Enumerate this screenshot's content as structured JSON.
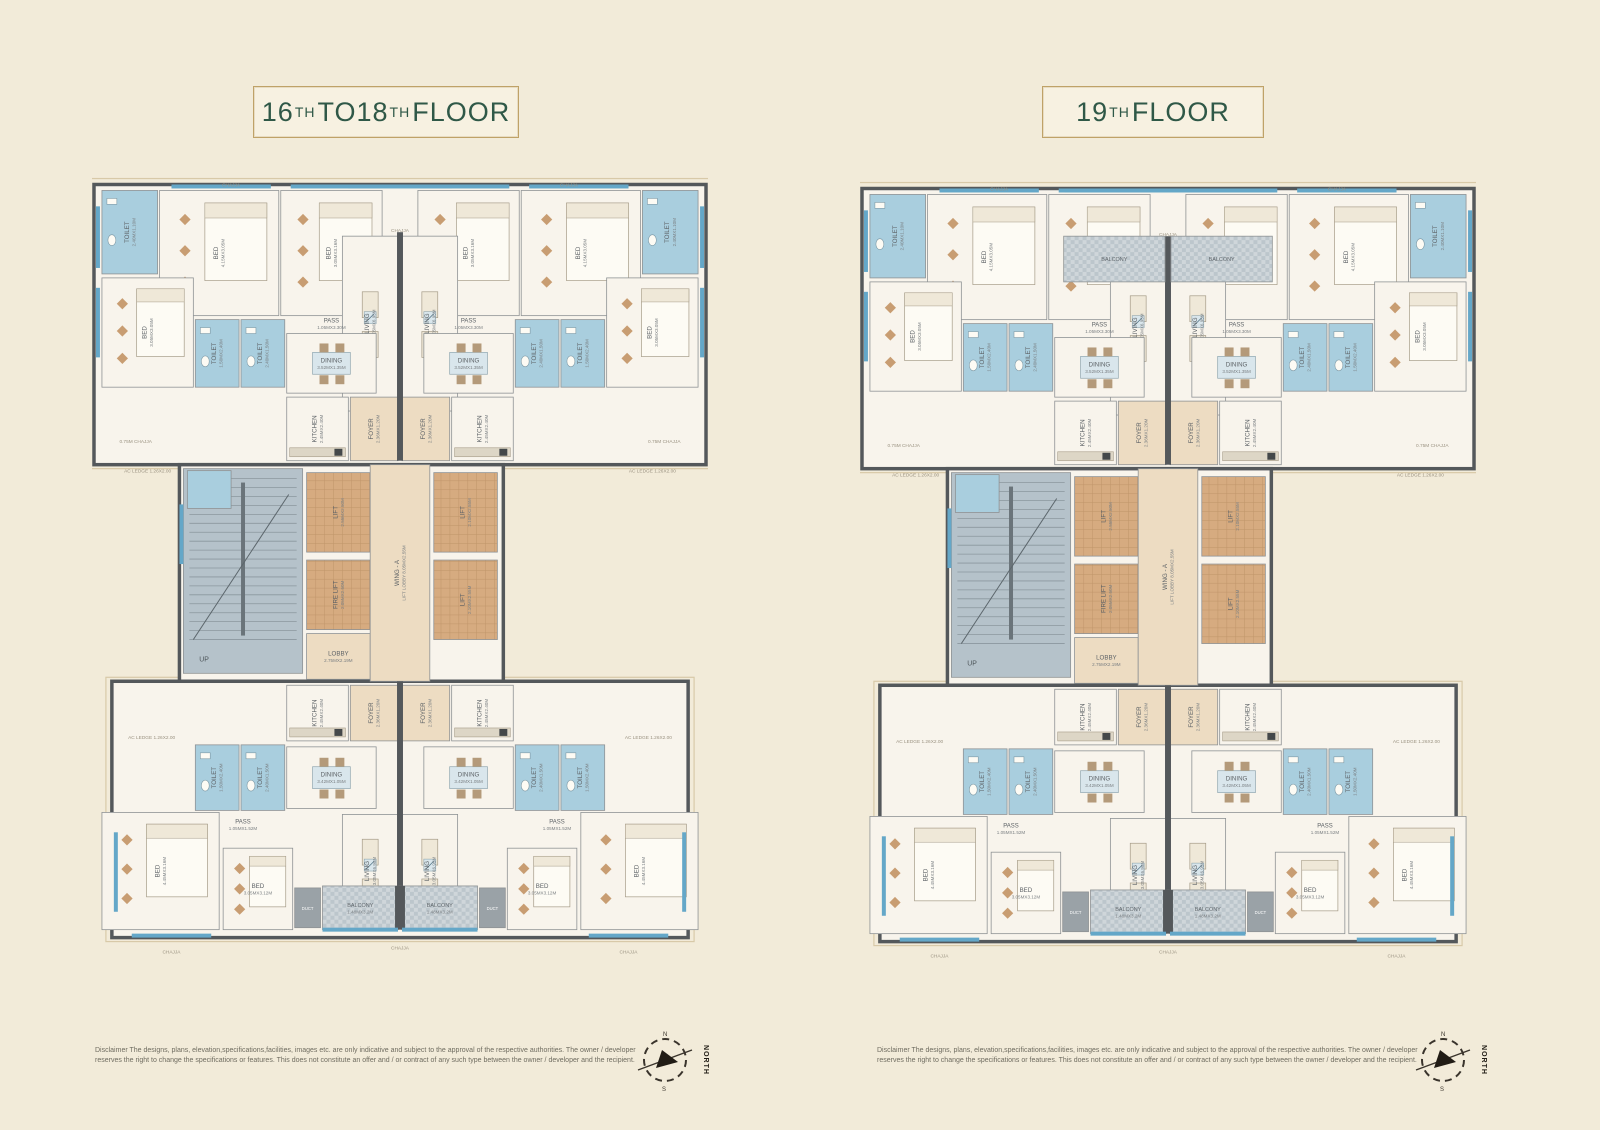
{
  "shared": {
    "disclaimer": "Disclaimer The designs, plans, elevation,specifications,facilities, images etc. are only indicative and subject to the approval of the respective authorities. The owner / developer reserves the right to change the specifications or features. This does not constitute an offer and / or contract of any such type between the owner / developer and the recipient.",
    "compass_label": "NORTH"
  },
  "colors": {
    "page_bg": "#f2ebd9",
    "floor": "#f8f4ec",
    "wall": "#54585b",
    "toilet_blue": "#a9cede",
    "window_blue": "#64a7c8",
    "lift_tan": "#d6ab80",
    "lift_line": "#bf9469",
    "lobby_peach": "#eddcc2",
    "stairs_gray": "#b5c2ca",
    "balcony_gray": "#cfd6da",
    "balcony_check": "#bcc6cc",
    "duct_gray": "#9aa2a7",
    "furniture_tan": "#c89d72",
    "furniture_cream": "#efe8d8",
    "table_blue": "#d9e6ec",
    "title_green": "#2f5847",
    "gold_border": "#bfa268",
    "label_text": "#5d6266",
    "note_text": "#9a9281",
    "chajja_line": "#d8c9a8"
  },
  "panels": [
    {
      "id": "floors-16-18",
      "title_text": "16TH TO 18TH FLOOR",
      "title_parts": [
        {
          "t": "16"
        },
        {
          "t": "TH",
          "sup": true
        },
        {
          "t": " TO "
        },
        {
          "t": "18"
        },
        {
          "t": "TH",
          "sup": true
        },
        {
          "t": " FLOOR"
        }
      ],
      "variant": "A"
    },
    {
      "id": "floor-19",
      "title_text": "19TH FLOOR",
      "title_parts": [
        {
          "t": "19"
        },
        {
          "t": "TH",
          "sup": true
        },
        {
          "t": " FLOOR"
        }
      ],
      "variant": "B"
    }
  ],
  "plan": {
    "width": 620,
    "height": 790,
    "base": [
      {
        "t": "chajja",
        "x": -6,
        "y": 2,
        "w": 632,
        "h": 292
      },
      {
        "t": "chajja",
        "x": 14,
        "y": 504,
        "w": 592,
        "h": 266
      },
      {
        "t": "wing",
        "x": 2,
        "y": 8,
        "w": 616,
        "h": 282
      },
      {
        "t": "wing",
        "x": 88,
        "y": 290,
        "w": 326,
        "h": 218
      },
      {
        "t": "wing",
        "x": 20,
        "y": 508,
        "w": 580,
        "h": 258
      },
      {
        "t": "toilet",
        "l": "TOILET",
        "d": "2.40MX1.10M",
        "x": 10,
        "y": 14,
        "w": 56,
        "h": 84,
        "r": 1,
        "m": 1
      },
      {
        "t": "bed",
        "l": "BED",
        "d": "4.15MX3.05M",
        "x": 68,
        "y": 14,
        "w": 120,
        "h": 126,
        "r": 1,
        "m": 1
      },
      {
        "t": "bed",
        "l": "BED",
        "d": "3.05MX3.16M",
        "x": 190,
        "y": 14,
        "w": 102,
        "h": 126,
        "r": 1,
        "m": 1
      },
      {
        "t": "living",
        "l": "LIVING",
        "d": "3.05MX6.95M",
        "x": 252,
        "y": 60,
        "w": 56,
        "h": 176,
        "r": 1,
        "m": 1
      },
      {
        "t": "bed",
        "l": "BED",
        "d": "3.05MX3.05M",
        "x": 10,
        "y": 102,
        "w": 92,
        "h": 110,
        "r": 1,
        "m": 1
      },
      {
        "t": "toilet",
        "l": "TOILET",
        "d": "1.50MX2.40M",
        "x": 104,
        "y": 144,
        "w": 44,
        "h": 68,
        "r": 1,
        "m": 1
      },
      {
        "t": "toilet",
        "l": "TOILET",
        "d": "2.40MX1.50M",
        "x": 150,
        "y": 144,
        "w": 44,
        "h": 68,
        "r": 1,
        "m": 1
      },
      {
        "t": "label",
        "l": "PASS",
        "d": "1.05MX3.30M",
        "x": 241,
        "y": 148,
        "m": 1
      },
      {
        "t": "dining",
        "l": "DINING",
        "d": "3.52MX1.35M",
        "x": 196,
        "y": 158,
        "w": 90,
        "h": 60,
        "m": 1
      },
      {
        "t": "kitchen",
        "l": "KITCHEN",
        "d": "2.45MX2.40M",
        "x": 196,
        "y": 222,
        "w": 62,
        "h": 64,
        "r": 1,
        "m": 1
      },
      {
        "t": "foyer",
        "l": "FOYER",
        "d": "2.36MX1.20M",
        "x": 260,
        "y": 222,
        "w": 48,
        "h": 64,
        "r": 1,
        "m": 1
      },
      {
        "t": "stairs",
        "l": "UP",
        "x": 92,
        "y": 294,
        "w": 120,
        "h": 206
      },
      {
        "t": "toilet",
        "l": "",
        "x": 96,
        "y": 296,
        "w": 44,
        "h": 38
      },
      {
        "t": "lift",
        "l": "LIFT",
        "d": "2.55MX2.50M",
        "x": 216,
        "y": 298,
        "w": 64,
        "h": 80,
        "r": 1
      },
      {
        "t": "lift",
        "l": "FIRE LIFT",
        "d": "2.05MX2.50M",
        "x": 216,
        "y": 386,
        "w": 64,
        "h": 70,
        "r": 1
      },
      {
        "t": "lobby",
        "l": "LOBBY",
        "d": "2.75MX2.19M",
        "x": 216,
        "y": 460,
        "w": 64,
        "h": 46
      },
      {
        "t": "lobby",
        "l": "WING - A",
        "d": "LIFT LOBBY 8.05MX2.55M",
        "x": 280,
        "y": 290,
        "w": 60,
        "h": 218,
        "r": 1
      },
      {
        "t": "lift",
        "l": "LIFT",
        "d": "2.10MX2.55M",
        "x": 344,
        "y": 298,
        "w": 64,
        "h": 80,
        "r": 1
      },
      {
        "t": "lift",
        "l": "LIFT",
        "d": "2.10MX2.55M",
        "x": 344,
        "y": 386,
        "w": 64,
        "h": 80,
        "r": 1
      },
      {
        "t": "foyer",
        "l": "FOYER",
        "d": "2.36MX1.20M",
        "x": 260,
        "y": 512,
        "w": 48,
        "h": 56,
        "r": 1,
        "m": 1
      },
      {
        "t": "kitchen",
        "l": "KITCHEN",
        "d": "2.45MX2.40M",
        "x": 196,
        "y": 512,
        "w": 62,
        "h": 56,
        "r": 1,
        "m": 1
      },
      {
        "t": "toilet",
        "l": "TOILET",
        "d": "1.50MX2.40M",
        "x": 104,
        "y": 572,
        "w": 44,
        "h": 66,
        "r": 1,
        "m": 1
      },
      {
        "t": "toilet",
        "l": "TOILET",
        "d": "2.40MX1.50M",
        "x": 150,
        "y": 572,
        "w": 44,
        "h": 66,
        "r": 1,
        "m": 1
      },
      {
        "t": "dining",
        "l": "DINING",
        "d": "3.42MX1.05M",
        "x": 196,
        "y": 574,
        "w": 90,
        "h": 62,
        "m": 1
      },
      {
        "t": "living",
        "l": "LIVING",
        "d": "3.05MX6.95M",
        "x": 252,
        "y": 642,
        "w": 56,
        "h": 114,
        "r": 1,
        "m": 1
      },
      {
        "t": "label",
        "l": "PASS",
        "d": "1.05MX1.52M",
        "x": 152,
        "y": 652,
        "m": 1
      },
      {
        "t": "bed",
        "l": "BED",
        "d": "4.45MX3.16M",
        "x": 10,
        "y": 640,
        "w": 118,
        "h": 118,
        "r": 1,
        "m": 1
      },
      {
        "t": "bed",
        "l": "BED",
        "d": "3.05MX3.12M",
        "x": 132,
        "y": 676,
        "w": 70,
        "h": 82,
        "m": 1
      },
      {
        "t": "duct",
        "l": "DUCT",
        "x": 204,
        "y": 716,
        "w": 26,
        "h": 40,
        "m": 1
      },
      {
        "t": "balcony",
        "l": "BALCONY",
        "d": "1.48MX3.2M",
        "x": 232,
        "y": 714,
        "w": 76,
        "h": 44,
        "m": 1
      },
      {
        "t": "wall",
        "x": 307,
        "y": 56,
        "w": 6,
        "h": 230
      },
      {
        "t": "wall",
        "x": 307,
        "y": 508,
        "w": 6,
        "h": 206
      },
      {
        "t": "wall",
        "x": 305,
        "y": 714,
        "w": 10,
        "h": 44
      },
      {
        "t": "win",
        "x": 80,
        "y": 8,
        "w": 100,
        "h": 4,
        "m": 1
      },
      {
        "t": "win",
        "x": 200,
        "y": 8,
        "w": 90,
        "h": 4,
        "m": 1
      },
      {
        "t": "win",
        "x": 258,
        "y": 8,
        "w": 104,
        "h": 4
      },
      {
        "t": "win",
        "x": 4,
        "y": 30,
        "w": 4,
        "h": 62,
        "m": 1
      },
      {
        "t": "win",
        "x": 4,
        "y": 112,
        "w": 4,
        "h": 70,
        "m": 1
      },
      {
        "t": "win",
        "x": 22,
        "y": 660,
        "w": 4,
        "h": 80,
        "m": 1
      },
      {
        "t": "win",
        "x": 40,
        "y": 762,
        "w": 80,
        "h": 4,
        "m": 1
      },
      {
        "t": "win",
        "x": 232,
        "y": 756,
        "w": 76,
        "h": 4,
        "m": 1
      },
      {
        "t": "win",
        "x": 88,
        "y": 330,
        "w": 4,
        "h": 60
      },
      {
        "t": "note",
        "l": "CHAJJA",
        "x": 140,
        "y": 4,
        "m": 1
      },
      {
        "t": "note",
        "l": "CHAJJA",
        "x": 310,
        "y": 50
      },
      {
        "t": "note",
        "l": "0.75M CHAJJA",
        "x": 44,
        "y": 262,
        "m": 1
      },
      {
        "t": "note",
        "l": "AC LEDGE 1.26X2.00",
        "x": 56,
        "y": 292,
        "m": 1
      },
      {
        "t": "note",
        "l": "AC LEDGE 1.26X2.00",
        "x": 60,
        "y": 560,
        "m": 1
      },
      {
        "t": "note",
        "l": "CHAJJA",
        "x": 80,
        "y": 776,
        "m": 1
      },
      {
        "t": "note",
        "l": "CHAJJA",
        "x": 310,
        "y": 772
      }
    ],
    "variants": {
      "A": {
        "extra": []
      },
      "B": {
        "extra": [
          {
            "t": "balcony",
            "l": "BALCONY",
            "d": "",
            "x": 205,
            "y": 56,
            "w": 102,
            "h": 46,
            "m": 1
          },
          {
            "t": "win",
            "x": 206,
            "y": 8,
            "w": 208,
            "h": 4
          }
        ]
      }
    }
  }
}
